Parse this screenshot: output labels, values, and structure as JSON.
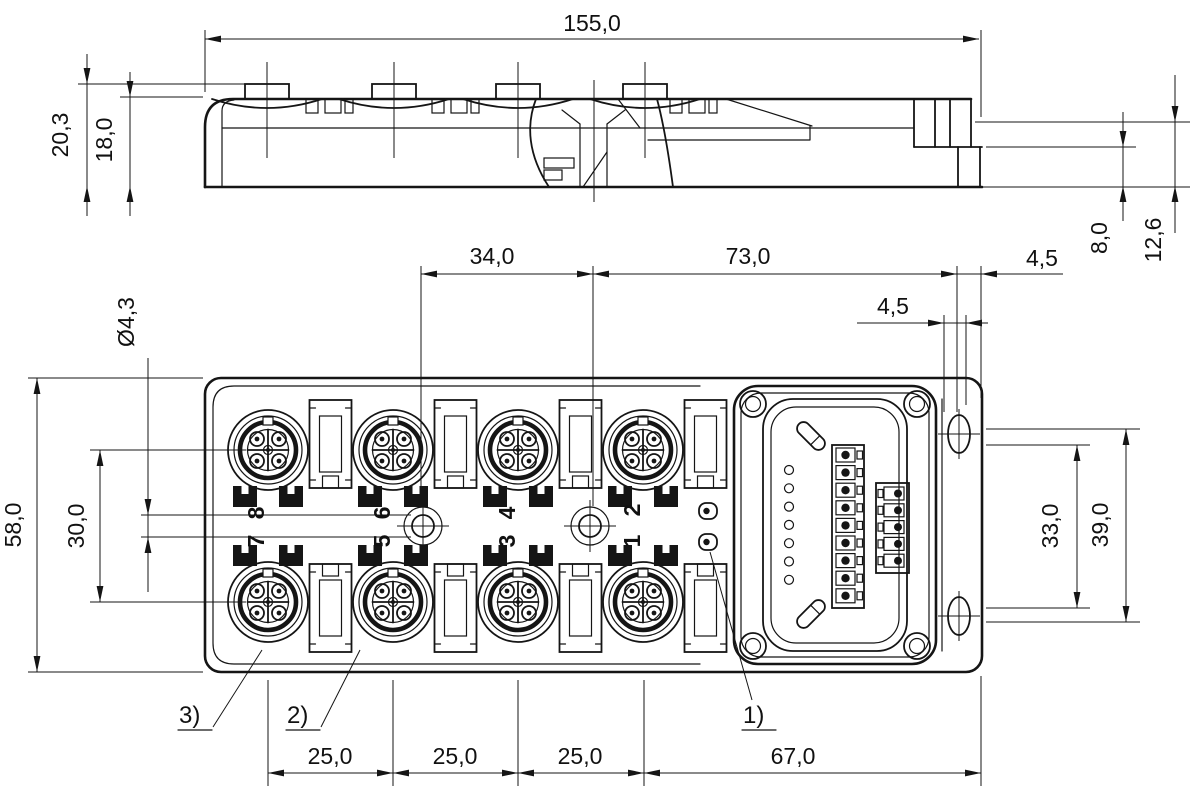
{
  "side_view": {
    "overall_length": "155,0",
    "total_height": "20,3",
    "body_height": "18,0",
    "step_height": "8,0",
    "flange_offset": "12,6"
  },
  "front_view": {
    "hole_spacing": "34,0",
    "hole_to_end": "73,0",
    "tab_offset_upper": "4,5",
    "tab_offset_lower": "4,5",
    "body_width": "58,0",
    "port_row_spacing": "30,0",
    "mounting_hole_diameter": "Ø4,3",
    "slot_spacing_inner": "33,0",
    "slot_spacing_outer": "39,0",
    "port_pitch_1": "25,0",
    "port_pitch_2": "25,0",
    "port_pitch_3": "25,0",
    "end_section_length": "67,0",
    "ports_top": [
      "8",
      "6",
      "4",
      "2"
    ],
    "ports_bottom": [
      "7",
      "5",
      "3",
      "1"
    ],
    "callout_1": "1)",
    "callout_2": "2)",
    "callout_3": "3)"
  },
  "style": {
    "line_color": "#151515",
    "paper_color": "#ffffff"
  }
}
